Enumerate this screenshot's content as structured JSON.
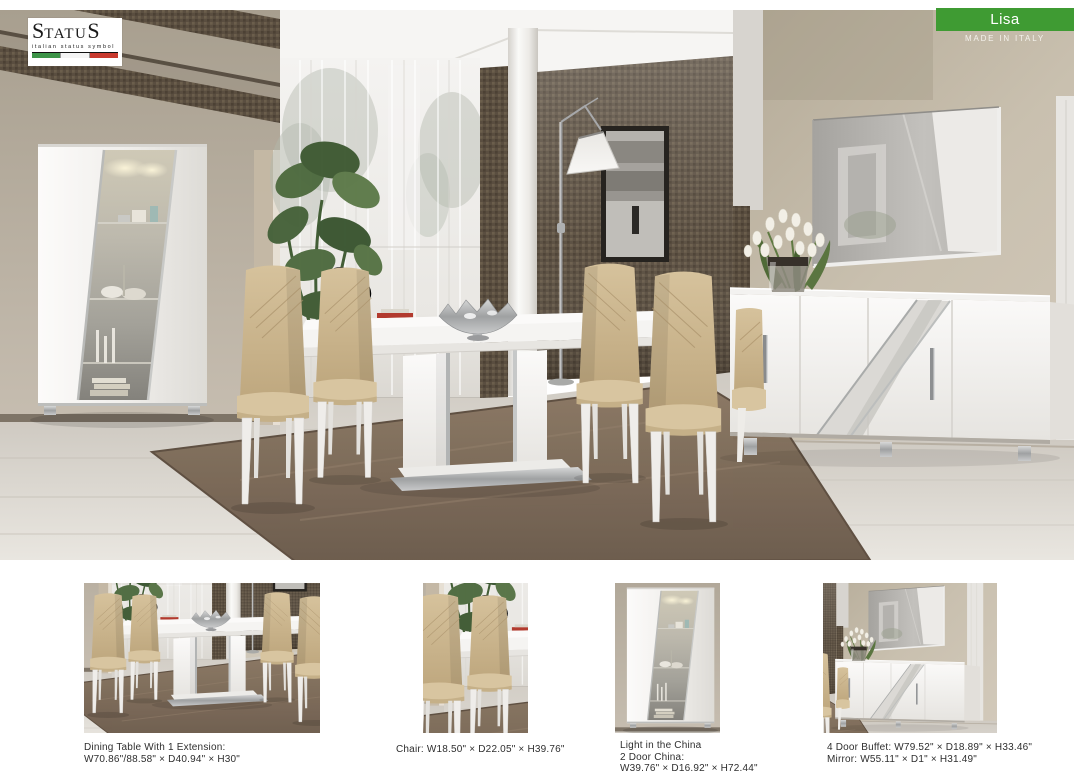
{
  "brand": {
    "name": "STATUS",
    "name_parts": [
      "S",
      "TATU",
      "S"
    ],
    "tagline": "italian status symbol",
    "flag_colors": [
      "#3d9448",
      "#f4f4f4",
      "#c8392e"
    ]
  },
  "collection": {
    "name": "Lisa",
    "badge_color": "#3f9b33",
    "made_in": "MADE IN ITALY"
  },
  "products": [
    {
      "id": "dining-table",
      "caption_lines": [
        "Dining Table With 1 Extension:",
        "W70.86\"/88.58\" × D40.94\" × H30\""
      ]
    },
    {
      "id": "chair",
      "caption_lines": [
        "Chair: W18.50\" × D22.05\" × H39.76\""
      ]
    },
    {
      "id": "two-door-china",
      "caption_lines": [
        "Light in the China",
        "2 Door China:",
        "W39.76\" × D16.92\" × H72.44\""
      ]
    },
    {
      "id": "buffet-and-mirror",
      "caption_lines": [
        "4 Door Buffet: W79.52\" × D18.89\" × H33.46\"",
        "Mirror: W55.11\" × D1\" × H31.49\""
      ]
    }
  ]
}
